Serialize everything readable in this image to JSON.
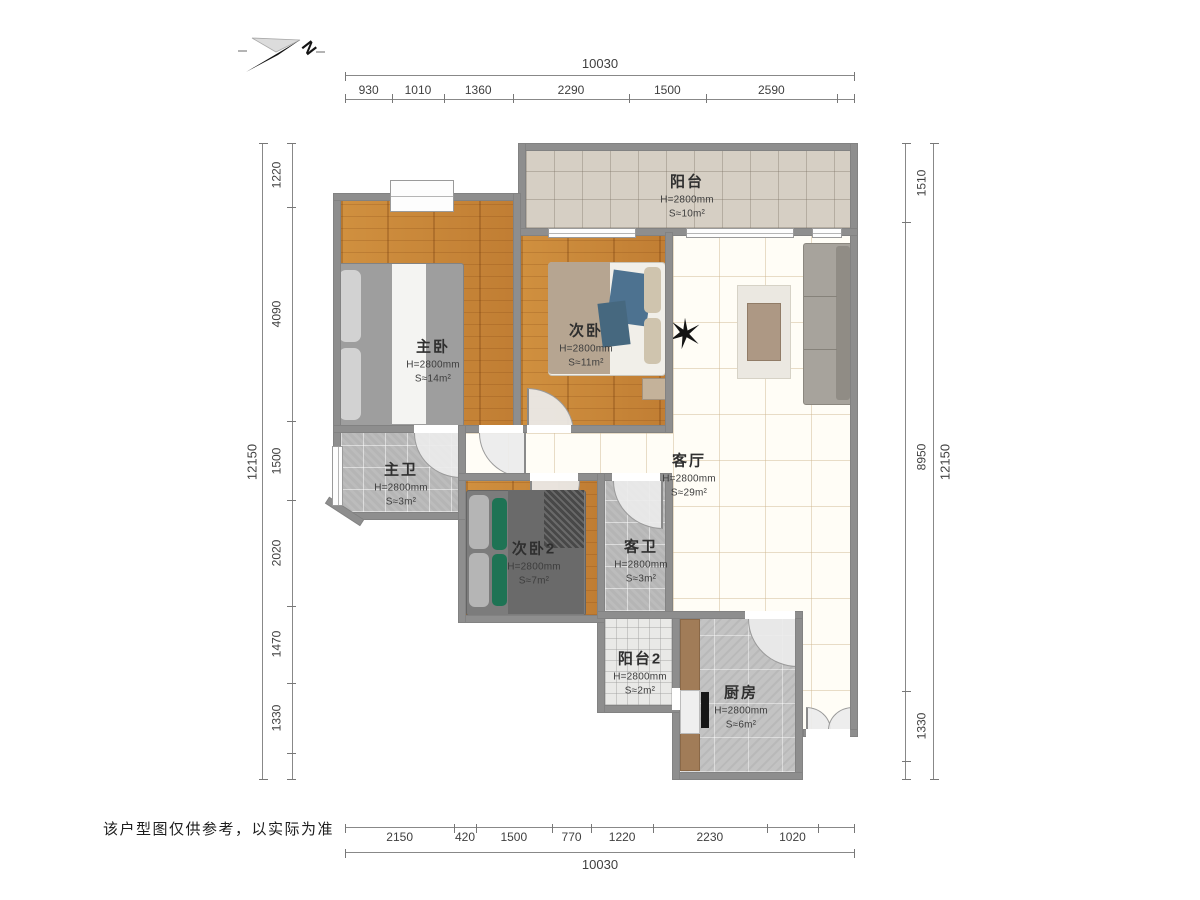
{
  "north": {
    "label": "N"
  },
  "disclaimer": "该户型图仅供参考，以实际为准",
  "rooms": [
    {
      "id": "balcony",
      "name": "阳台",
      "height": "H=2800mm",
      "area": "S≈10m²"
    },
    {
      "id": "master-bedroom",
      "name": "主卧",
      "height": "H=2800mm",
      "area": "S≈14m²"
    },
    {
      "id": "bedroom-2",
      "name": "次卧",
      "height": "H=2800mm",
      "area": "S≈11m²"
    },
    {
      "id": "master-bath",
      "name": "主卫",
      "height": "H=2800mm",
      "area": "S≈3m²"
    },
    {
      "id": "living-room",
      "name": "客厅",
      "height": "H=2800mm",
      "area": "S≈29m²"
    },
    {
      "id": "bedroom-3",
      "name": "次卧2",
      "height": "H=2800mm",
      "area": "S≈7m²"
    },
    {
      "id": "guest-bath",
      "name": "客卫",
      "height": "H=2800mm",
      "area": "S≈3m²"
    },
    {
      "id": "balcony-2",
      "name": "阳台2",
      "height": "H=2800mm",
      "area": "S≈2m²"
    },
    {
      "id": "kitchen",
      "name": "厨房",
      "height": "H=2800mm",
      "area": "S≈6m²"
    }
  ],
  "dimensions": {
    "top": {
      "total": "10030",
      "segments": [
        "930",
        "1010",
        "1360",
        "2290",
        "1500",
        "2590"
      ]
    },
    "bottom": {
      "total": "10030",
      "segments": [
        "2150",
        "420",
        "1500",
        "770",
        "1220",
        "2230",
        "1020"
      ]
    },
    "left": {
      "total": "12150",
      "segments": [
        "1220",
        "4090",
        "1500",
        "2020",
        "1470",
        "1330"
      ]
    },
    "right": {
      "total": "12150",
      "segments": [
        "1510",
        "8950",
        "1330"
      ]
    }
  },
  "colors": {
    "wall": "#8e8e8e",
    "wood_floor": "#c9873f",
    "living_tile": "#fffdf6",
    "balcony_tile": "#d6cfc4",
    "bath_tile": "#bcbcbc",
    "sofa": "#a7a39c",
    "bed_blue": "#4d7290",
    "pillow_green": "#1e7354"
  }
}
